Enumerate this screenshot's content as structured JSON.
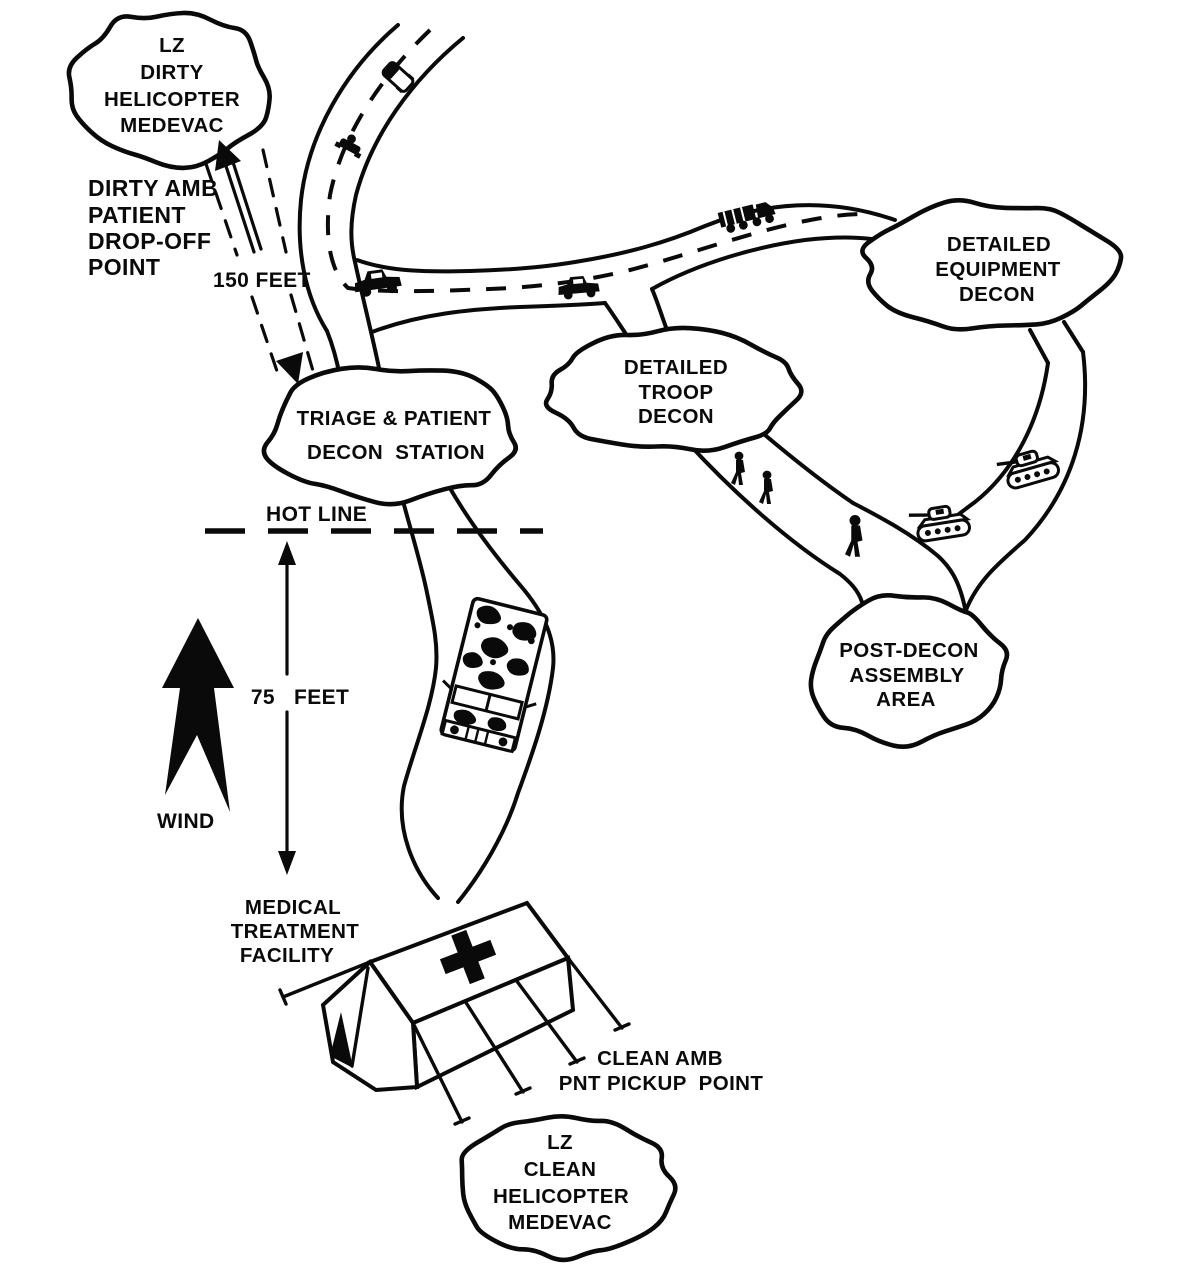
{
  "colors": {
    "ink": "#0a0a0a",
    "paper": "#ffffff"
  },
  "clouds": {
    "lz_dirty": {
      "lines": [
        "LZ",
        "DIRTY",
        "HELICOPTER",
        "MEDEVAC"
      ]
    },
    "triage": {
      "lines": [
        "TRIAGE & PATIENT",
        "DECON  STATION"
      ]
    },
    "troop": {
      "lines": [
        "DETAILED",
        "TROOP",
        "DECON"
      ]
    },
    "equipment": {
      "lines": [
        "DETAILED",
        "EQUIPMENT",
        "DECON"
      ]
    },
    "post_decon": {
      "lines": [
        "POST-DECON",
        "ASSEMBLY",
        "AREA"
      ]
    },
    "lz_clean": {
      "lines": [
        "LZ",
        "CLEAN",
        "HELICOPTER",
        "MEDEVAC"
      ]
    }
  },
  "labels": {
    "dirty_amb": {
      "lines": [
        "DIRTY AMB",
        "PATIENT",
        "DROP-OFF",
        "POINT"
      ]
    },
    "dist_150": "150 FEET",
    "hot_line": "HOT LINE",
    "dist_75": {
      "value": "75",
      "unit": "FEET"
    },
    "wind": "WIND",
    "mtf": {
      "lines": [
        "MEDICAL",
        "TREATMENT",
        "FACILITY"
      ]
    },
    "clean_amb": {
      "lines": [
        "CLEAN AMB",
        "PNT PICKUP  POINT"
      ]
    }
  }
}
